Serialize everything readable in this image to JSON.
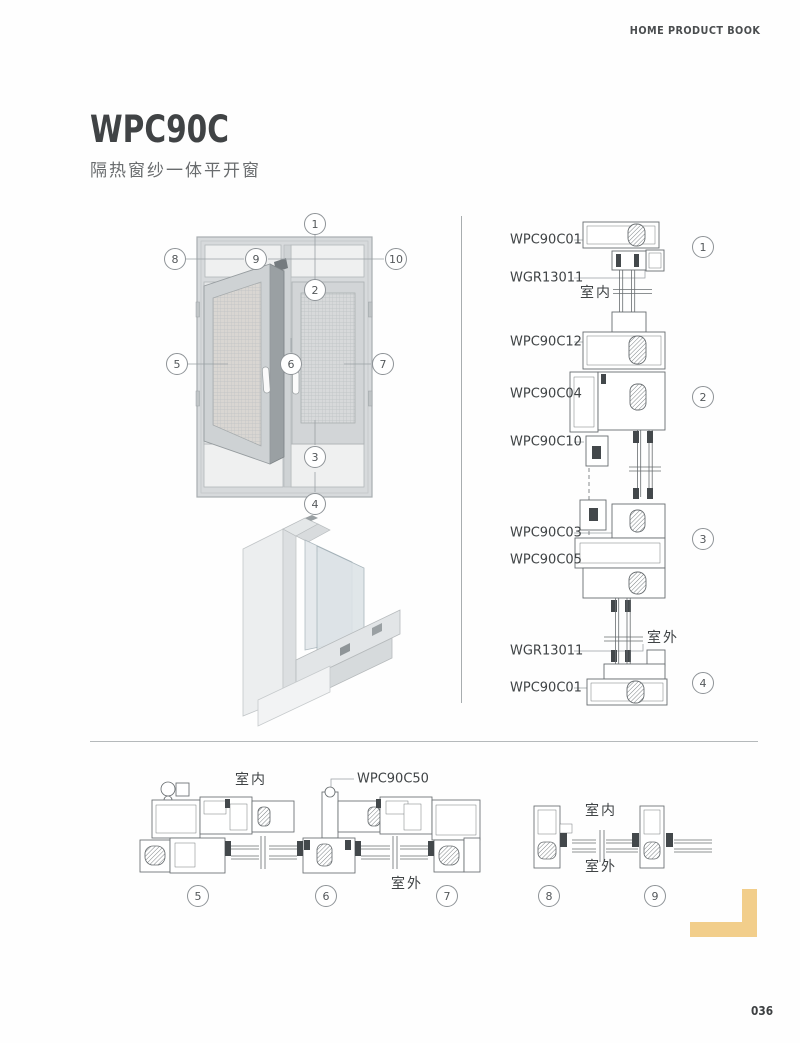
{
  "page": {
    "header": "HOME PRODUCT BOOK",
    "page_number": "036",
    "accent_color": "#F2CE8B"
  },
  "title": {
    "model": "WPC90C",
    "subtitle": "隔热窗纱一体平开窗"
  },
  "elevation": {
    "callouts": [
      "1",
      "2",
      "3",
      "4",
      "5",
      "6",
      "7",
      "8",
      "9",
      "10"
    ]
  },
  "vertical_section": {
    "labels": [
      "WPC90C01",
      "WGR13011",
      "WPC90C12",
      "WPC90C04",
      "WPC90C10",
      "WPC90C03",
      "WPC90C05",
      "WGR13011",
      "WPC90C01"
    ],
    "interior_label": "室内",
    "exterior_label": "室外",
    "callouts": [
      "1",
      "2",
      "3",
      "4"
    ]
  },
  "horizontal_section_a": {
    "interior_label": "室内",
    "exterior_label": "室外",
    "profile_label": "WPC90C50",
    "callouts": [
      "5",
      "6",
      "7"
    ]
  },
  "horizontal_section_b": {
    "interior_label": "室内",
    "exterior_label": "室外",
    "callouts": [
      "8",
      "9"
    ]
  }
}
